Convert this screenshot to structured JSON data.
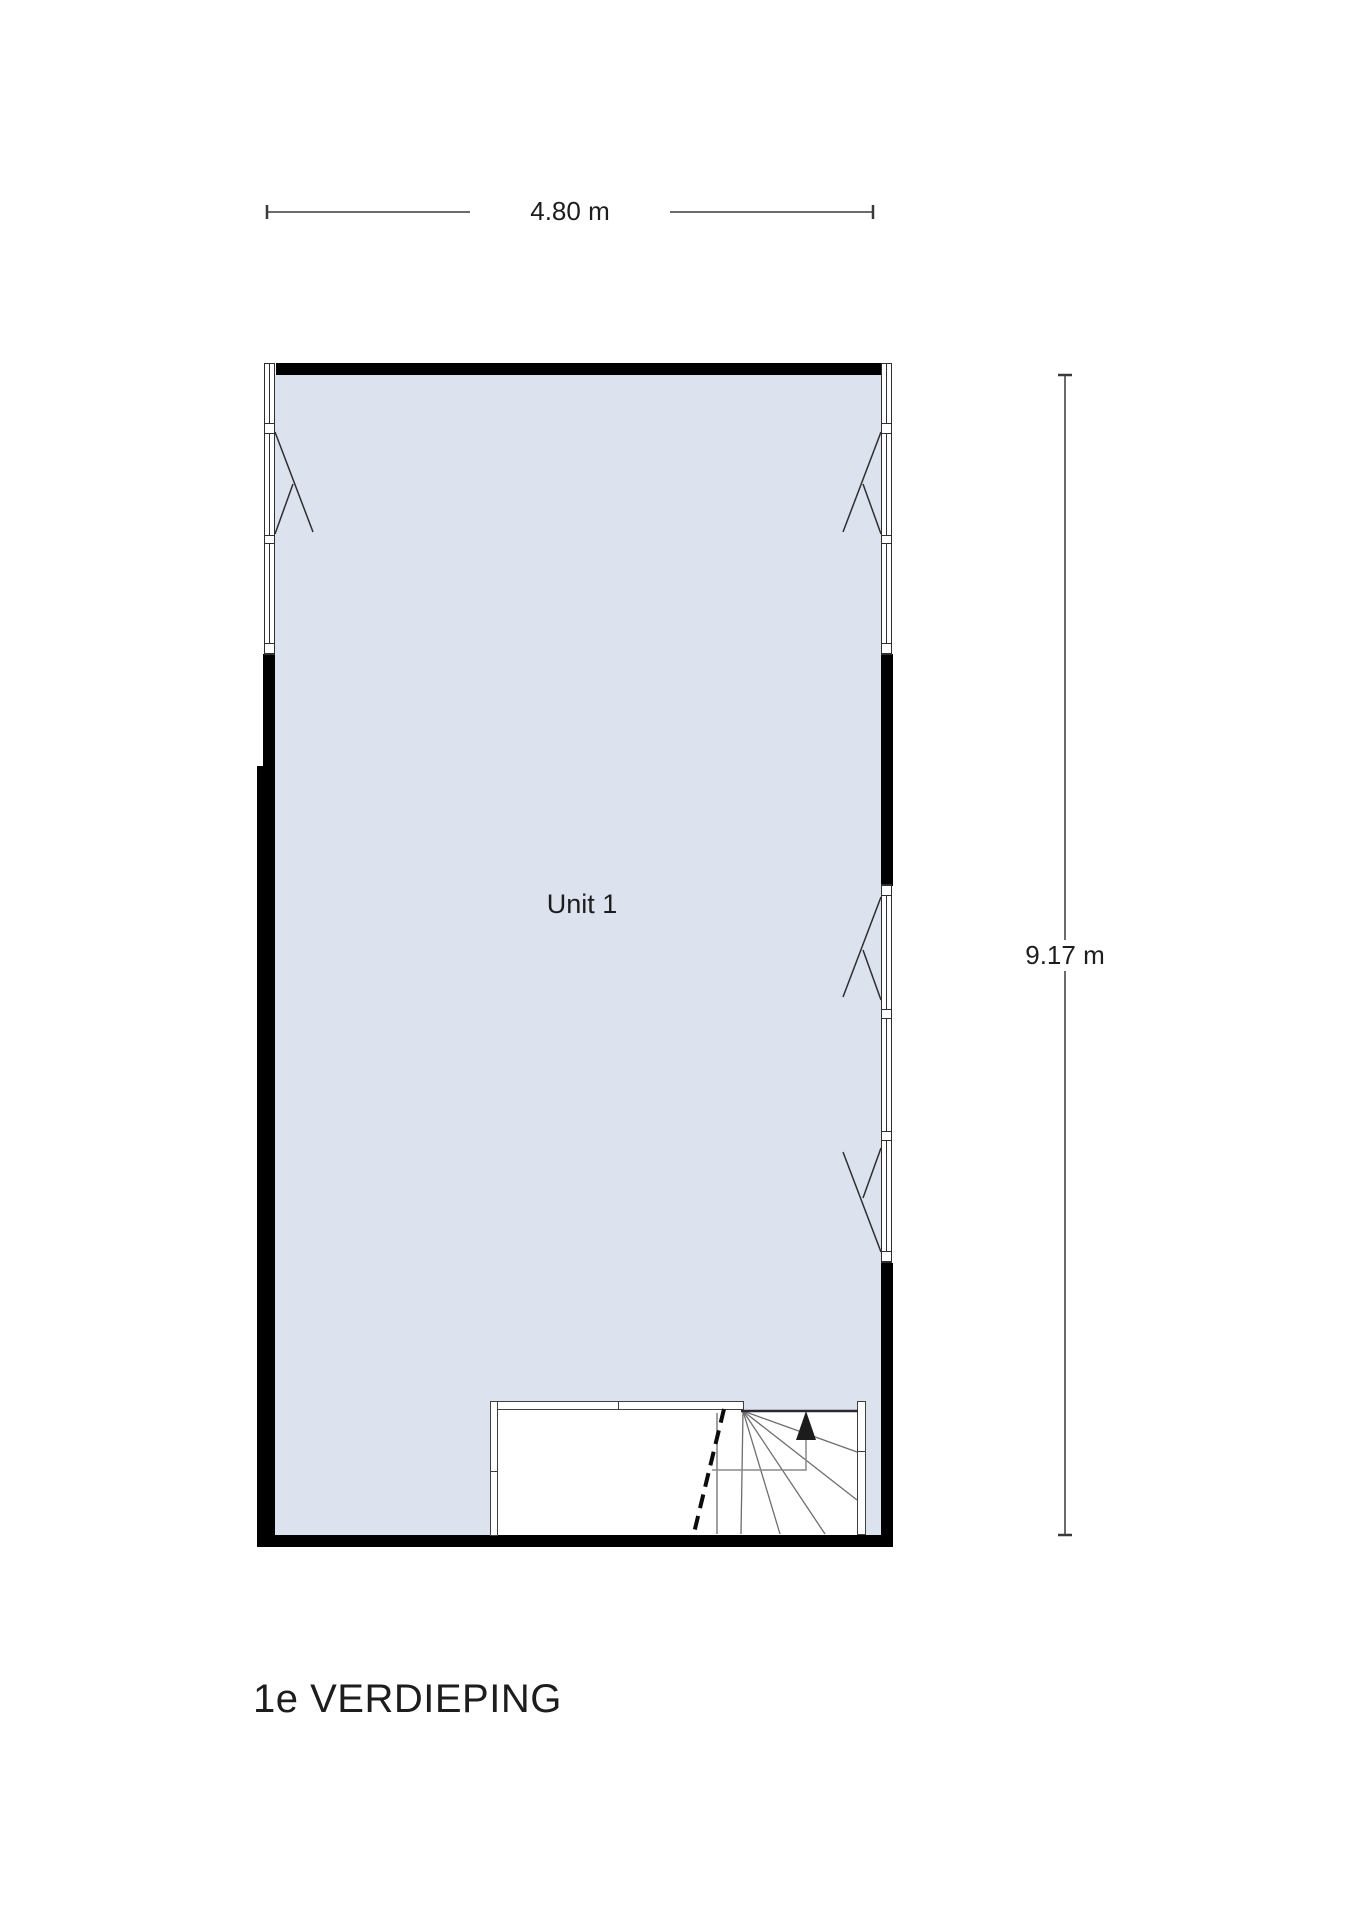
{
  "floorplan": {
    "title": "1e VERDIEPING",
    "room": {
      "label": "Unit 1"
    },
    "dimensions": {
      "width": "4.80 m",
      "height": "9.17 m"
    },
    "stairs": {
      "arrow_icon": "up-arrow"
    },
    "colors": {
      "floor": "#dde3ee",
      "wall": "#000000",
      "stair_lines": "#6d6d6d",
      "dimension_lines": "#3a3a3a",
      "text": "#1d1d1d"
    }
  }
}
